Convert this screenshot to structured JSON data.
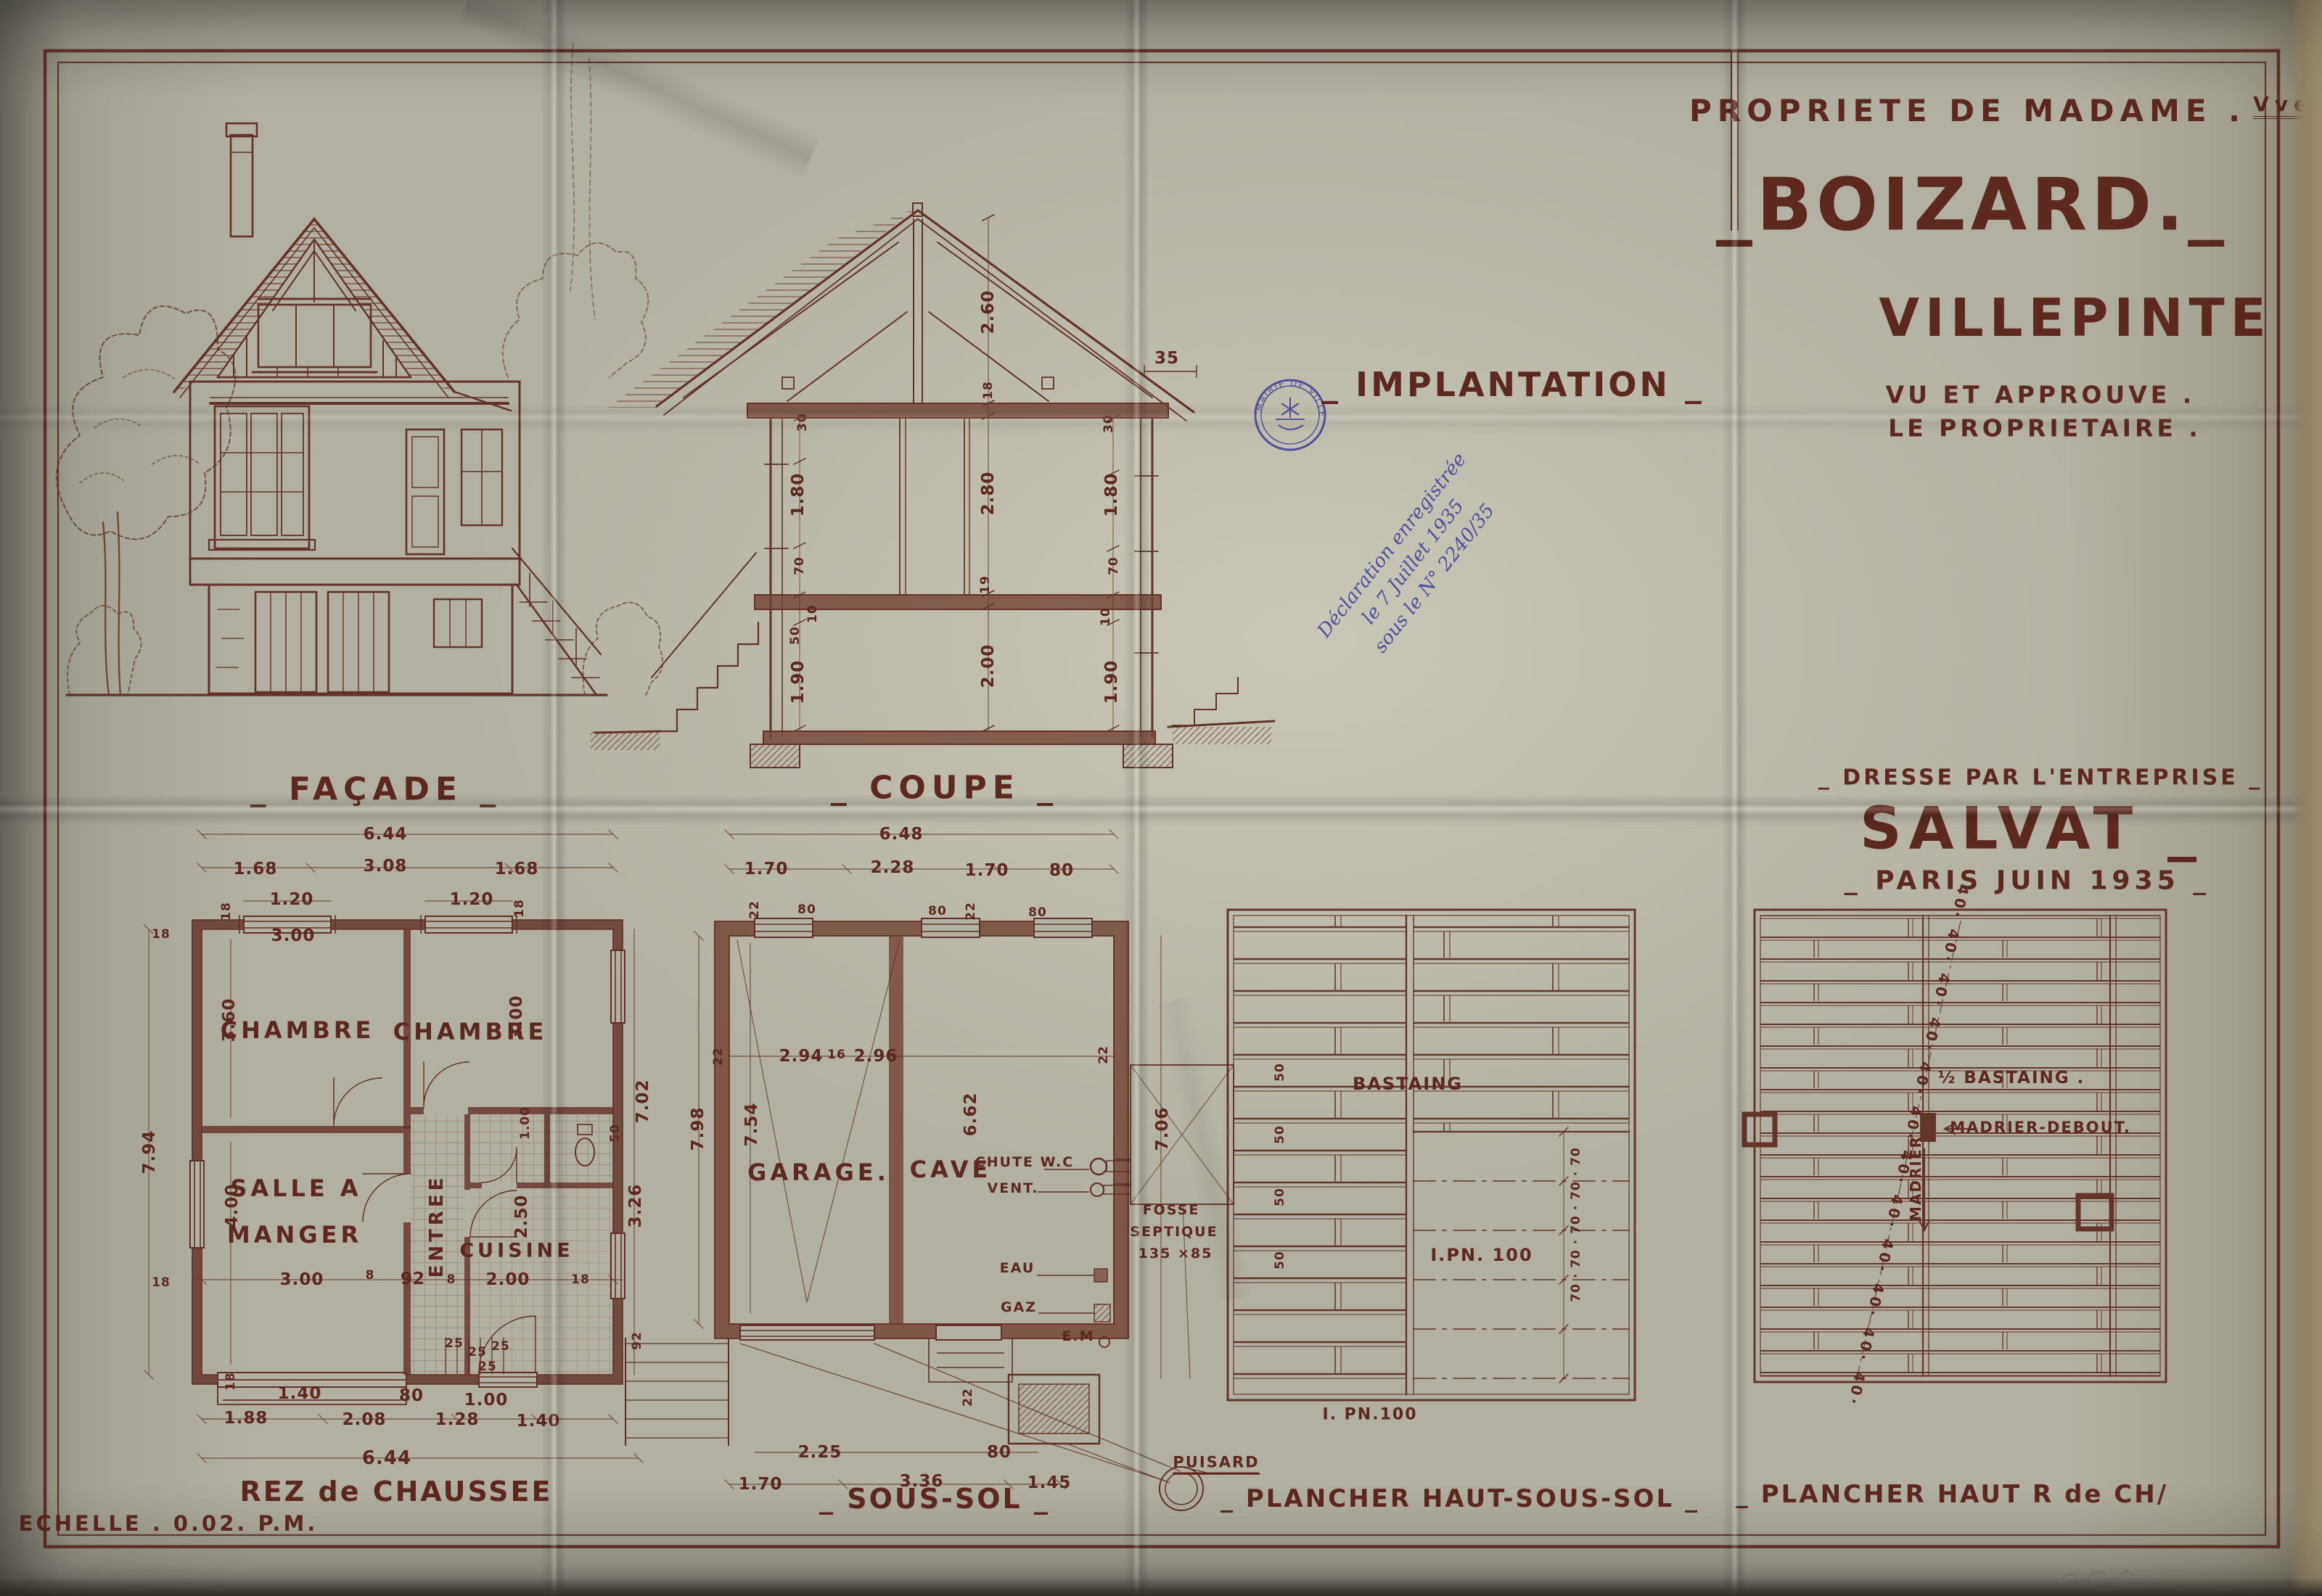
{
  "colors": {
    "ink": "#5c281f",
    "ink_soft": "#6d392c",
    "paper": "#b2b0a2",
    "stamp_blue": "#3d3d94",
    "note_blue": "#3c3c9a"
  },
  "titleblock": {
    "line1": "PROPRIETE DE MADAME .",
    "line1_sup": "Vve",
    "line2": "_BOIZARD._",
    "line3": "VILLEPINTE"
  },
  "approval": {
    "line1": "VU ET APPROUVE .",
    "line2": "LE PROPRIETAIRE ."
  },
  "firm": {
    "line1": "_ DRESSE PAR L'ENTREPRISE _",
    "line2": "SALVAT _",
    "line3": "_ PARIS JUIN 1935 _"
  },
  "implantation": {
    "label": "_ IMPLANTATION _"
  },
  "stamp": {
    "org": "MAIRIE DE VILLEPINTE"
  },
  "note": {
    "line1": "Déclaration enregistrée",
    "line2": "le 7 Juillet 1935",
    "line3": "sous le N° 2240/35"
  },
  "facade": {
    "label": "_ FAÇADE _"
  },
  "coupe": {
    "label": "_ COUPE _",
    "dims": {
      "roof": "2.60",
      "beam": "18",
      "floor1": "2.80",
      "slab": "19",
      "floor0": "2.00",
      "l30": "30",
      "l180": "1.80",
      "l70": "70",
      "l10": "10",
      "l50": "50",
      "l190": "1.90",
      "r35": "35",
      "r30": "30",
      "r180": "1.80",
      "r70": "70",
      "r10": "10",
      "r190": "1.90"
    }
  },
  "rez": {
    "label": "REZ de CHAUSSEE",
    "rooms": {
      "chambre1": "CHAMBRE",
      "chambre2": "CHAMBRE",
      "salle1": "SALLE A",
      "salle2": "MANGER",
      "entree": "ENTREE",
      "cuisine": "CUISINE"
    },
    "dims": {
      "top_total": "6.44",
      "top_l": "1.68",
      "top_m": "3.08",
      "top_r": "1.68",
      "win_l": "1.20",
      "win_r": "1.20",
      "t18l": "18",
      "t18r": "18",
      "left18a": "18",
      "left794": "7.94",
      "left360": "3.60",
      "left400": "4.00",
      "left18b": "18",
      "c1_w": "3.00",
      "c2_w": "3.00",
      "sam_w": "3.00",
      "cui_h": "2.50",
      "cui_w": "2.00",
      "ent_w": "92",
      "w8a": "8",
      "w8b": "8",
      "wc_d": "1.00",
      "wc_w": "50",
      "right702": "7.02",
      "right326": "3.26",
      "right92": "92",
      "right18": "18",
      "b140": "1.40",
      "b80": "80",
      "b100": "1.00",
      "b18": "18",
      "bb188": "1.88",
      "bb208": "2.08",
      "bb128": "1.28",
      "bb140": "1.40",
      "bot_total": "6.44",
      "s25a": "25",
      "s25b": "25",
      "s25c": "25",
      "s25d": "25"
    }
  },
  "soussol": {
    "label": "_ SOUS-SOL _",
    "puisard": "PUISARD",
    "rooms": {
      "garage": "GARAGE.",
      "cave": "CAVE"
    },
    "dims": {
      "top_total": "6.48",
      "t170l": "1.70",
      "t228": "2.28",
      "t170r": "1.70",
      "t80r": "80",
      "t22a": "22",
      "t80a": "80",
      "t80b": "80",
      "t22b": "22",
      "t80c": "80",
      "left798": "7.98",
      "g754": "7.54",
      "c662": "6.62",
      "right706": "7.06",
      "l22": "22",
      "g294": "2.94",
      "p16": "16",
      "c296": "2.96",
      "r22": "22",
      "b22": "22",
      "m225": "2.25",
      "m80": "80",
      "b170": "1.70",
      "b336": "3.36",
      "b145": "1.45"
    },
    "annos": {
      "chute": "CHUTE W.C",
      "vent": "VENT.",
      "eau": "EAU",
      "gaz": "GAZ",
      "em": "E.M",
      "fosse1": "FOSSE",
      "fosse2": "SEPTIQUE",
      "fosse3": "135 ×85"
    }
  },
  "plancher1": {
    "label": "_ PLANCHER HAUT-SOUS-SOL _",
    "bastaing": "BASTAING",
    "ipn_center": "I.PN. 100",
    "ipn_bottom": "I. PN.100",
    "dim70": "70 · 70 · 70 · 70 · 70",
    "d50a": "50",
    "d50b": "50",
    "d50c": "50",
    "d50d": "50"
  },
  "plancher2": {
    "label": "_ PLANCHER HAUT R de CH/",
    "half": "½ BASTAING .",
    "madrier_debout": "MADRIER-DEBOUT.",
    "madrier": "MADRIER",
    "chain": "40· 40· 40· 40· 40· 40· 40· 40· 40· 40· 40· 40·"
  },
  "footer": {
    "scale": "ECHELLE . 0.02. P.M."
  }
}
